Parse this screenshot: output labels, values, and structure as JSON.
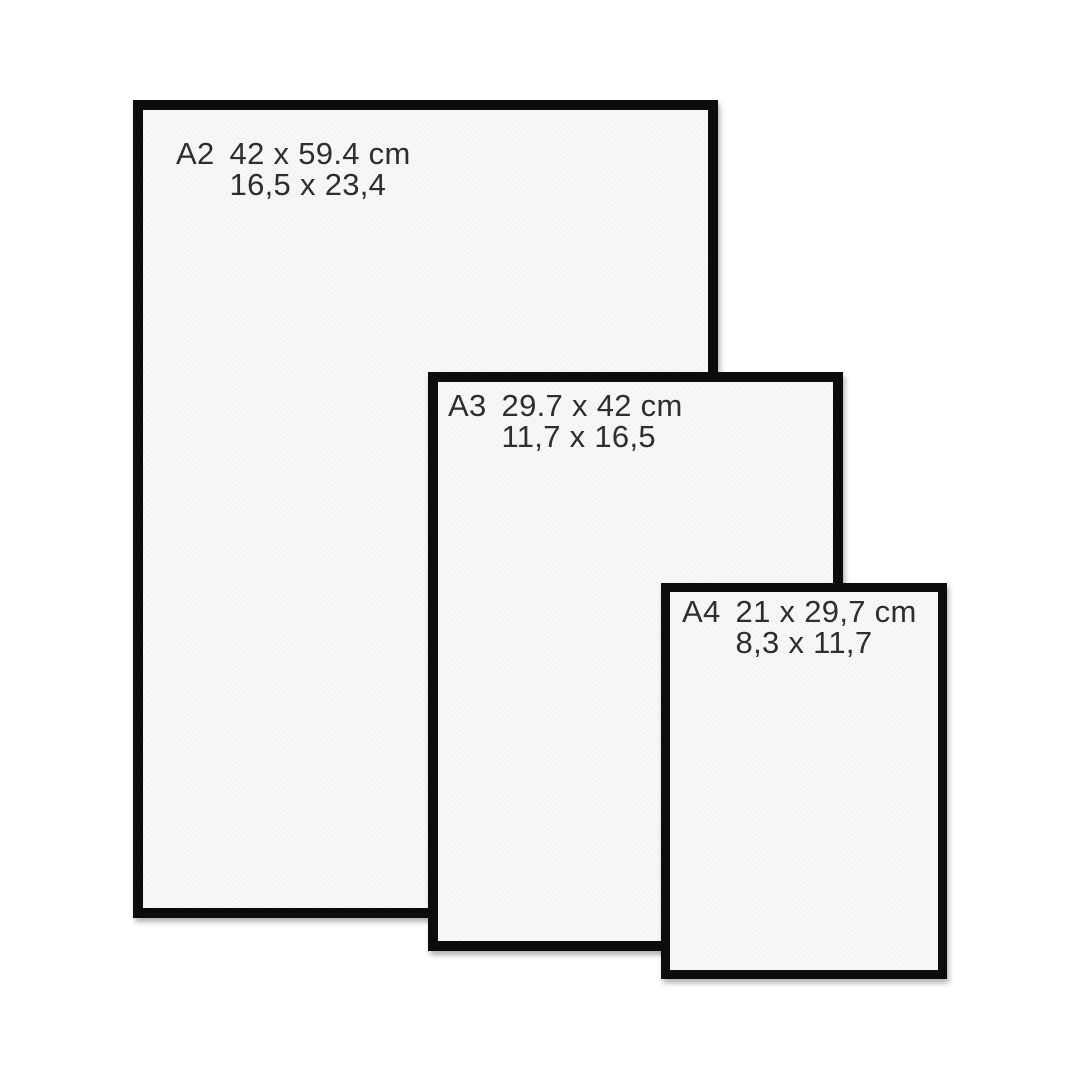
{
  "background_color": "#ffffff",
  "frame_border_color": "#0c0c0c",
  "paper_color": "#f8f8f8",
  "text_color": "#2e2e2e",
  "frames": [
    {
      "label": "A2",
      "size_cm": "42 x 59.4 cm",
      "size_in": "16,5 x 23,4"
    },
    {
      "label": "A3",
      "size_cm": "29.7 x 42 cm",
      "size_in": "11,7 x 16,5"
    },
    {
      "label": "A4",
      "size_cm": "21 x 29,7 cm",
      "size_in": "8,3 x 11,7"
    }
  ]
}
